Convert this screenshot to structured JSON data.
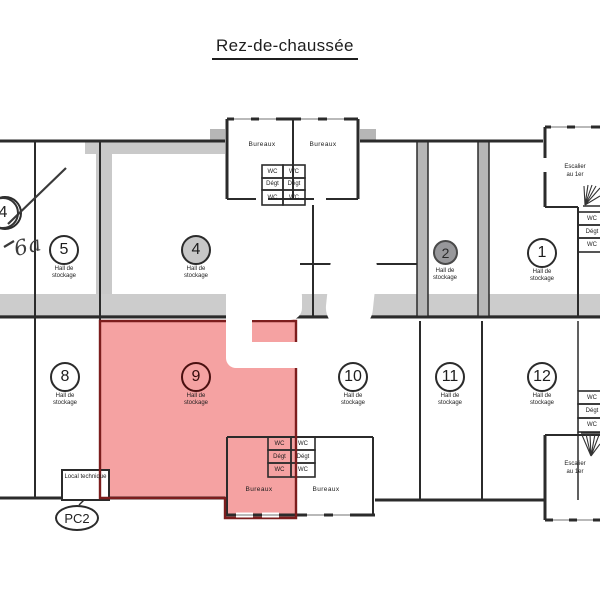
{
  "title": "Rez-de-chaussée",
  "plan": {
    "hall_label": "Hall de stockage",
    "bureaux_label": "Bureaux",
    "wc_label": "WC",
    "deg_label": "Dégt",
    "stairs_label_line1": "Escalier",
    "stairs_label_line2": "au 1er",
    "local_technique_label": "Local technique",
    "pc2_label": "PC2",
    "handwritten_note": "6a",
    "crossed_room_number": "4",
    "highlighted_room": "9",
    "rooms": [
      {
        "number": "5"
      },
      {
        "number": "4"
      },
      {
        "number": "2"
      },
      {
        "number": "1"
      },
      {
        "number": "8"
      },
      {
        "number": "9"
      },
      {
        "number": "10"
      },
      {
        "number": "11"
      },
      {
        "number": "12"
      }
    ],
    "colors": {
      "highlight_fill": "#f5a2a2",
      "highlight_border": "#7c1d1d",
      "wall": "#2b2b2b",
      "shading": "#c9c9c9",
      "room2_circle_fill": "#98989b",
      "room4_circle_fill": "#c7c7c7"
    }
  }
}
